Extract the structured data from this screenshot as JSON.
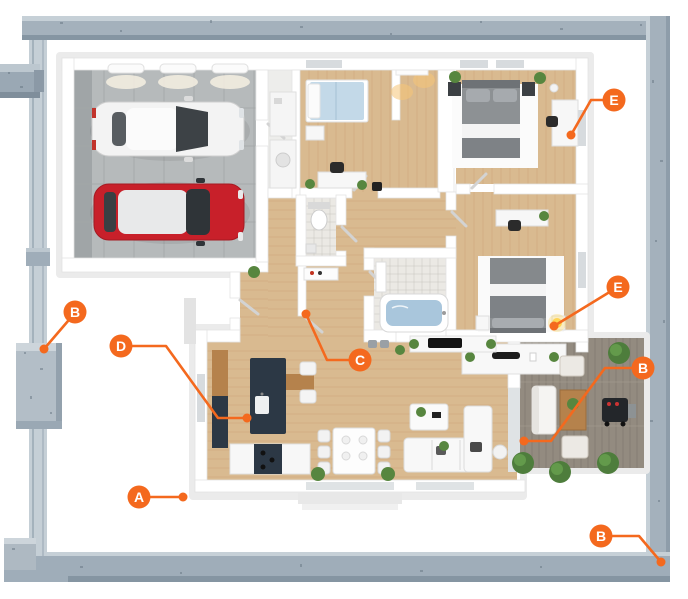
{
  "colors": {
    "accent": "#f4691e",
    "frame_steel": "#a7b3be",
    "frame_light": "#c6d0d7",
    "frame_dark": "#8595a2",
    "wood_floor": "#d9ba90",
    "garage_tile": "#b6babb",
    "deck_wood": "#938b80",
    "car_red": "#c8202a",
    "car_white": "#f3f3f3",
    "bed_blue": "#c3d9e8",
    "kitchen_dark": "#2c3845"
  },
  "callouts": [
    {
      "id": "a",
      "letter": "A",
      "cx": 139,
      "cy": 497,
      "line": [
        [
          151,
          497
        ],
        [
          183,
          497
        ]
      ],
      "dot": [
        183,
        497
      ]
    },
    {
      "id": "b-left",
      "letter": "B",
      "cx": 75,
      "cy": 312,
      "line": [
        [
          68,
          321
        ],
        [
          44,
          349
        ]
      ],
      "dot": [
        44,
        349
      ]
    },
    {
      "id": "b-patio",
      "letter": "B",
      "cx": 643,
      "cy": 368,
      "line": [
        [
          631,
          368
        ],
        [
          605,
          368
        ],
        [
          551,
          441
        ],
        [
          524,
          441
        ]
      ],
      "dot": [
        524,
        441
      ]
    },
    {
      "id": "b-corner",
      "letter": "B",
      "cx": 601,
      "cy": 536,
      "line": [
        [
          613,
          536
        ],
        [
          639,
          536
        ],
        [
          661,
          562
        ]
      ],
      "dot": [
        661,
        562
      ]
    },
    {
      "id": "c",
      "letter": "C",
      "cx": 360,
      "cy": 360,
      "line": [
        [
          348,
          360
        ],
        [
          327,
          360
        ],
        [
          306,
          314
        ]
      ],
      "dot": [
        306,
        314
      ]
    },
    {
      "id": "d",
      "letter": "D",
      "cx": 121,
      "cy": 346,
      "line": [
        [
          133,
          346
        ],
        [
          166,
          346
        ],
        [
          218,
          418
        ],
        [
          247,
          418
        ]
      ],
      "dot": [
        247,
        418
      ]
    },
    {
      "id": "e-desk",
      "letter": "E",
      "cx": 614,
      "cy": 100,
      "line": [
        [
          602,
          100
        ],
        [
          591,
          100
        ],
        [
          571,
          135
        ]
      ],
      "dot": [
        571,
        135
      ]
    },
    {
      "id": "e-lamp",
      "letter": "E",
      "cx": 618,
      "cy": 287,
      "line": [
        [
          608,
          293
        ],
        [
          554,
          326
        ]
      ],
      "dot": [
        554,
        326
      ]
    }
  ]
}
